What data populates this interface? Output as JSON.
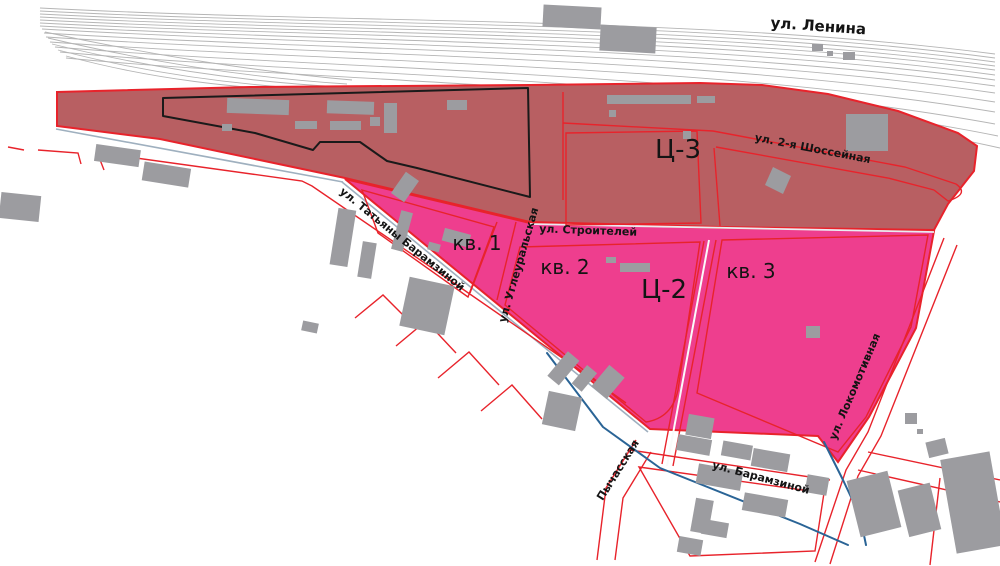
{
  "map": {
    "zones": {
      "c3": {
        "code": "Ц-3"
      },
      "c2": {
        "code": "Ц-2",
        "quarters": [
          "кв. 1",
          "кв. 2",
          "кв. 3"
        ]
      }
    },
    "streets": {
      "lenina": "ул. Ленина",
      "shosseynaya2": "ул. 2-я Шоссейная",
      "stroiteley": "ул. Строителей",
      "tatyany_baramzinoy": "ул. Татьяны Барамзиной",
      "ugleuralskaya": "ул. Углеуральская",
      "lokomotivnaya": "ул. Локомотивная",
      "baramzinoy": "ул. Барамзиной",
      "pychasskaya": "Пычасская"
    }
  },
  "colors": {
    "zone_c3_fill": "#b85f62",
    "zone_c2_fill": "#ee3e8e",
    "street_line": "#e8232b",
    "building": "#9c9ca0",
    "railway": "#b5b5b5",
    "waterline": "#2a6496",
    "site_outline": "#1a1a1a"
  }
}
